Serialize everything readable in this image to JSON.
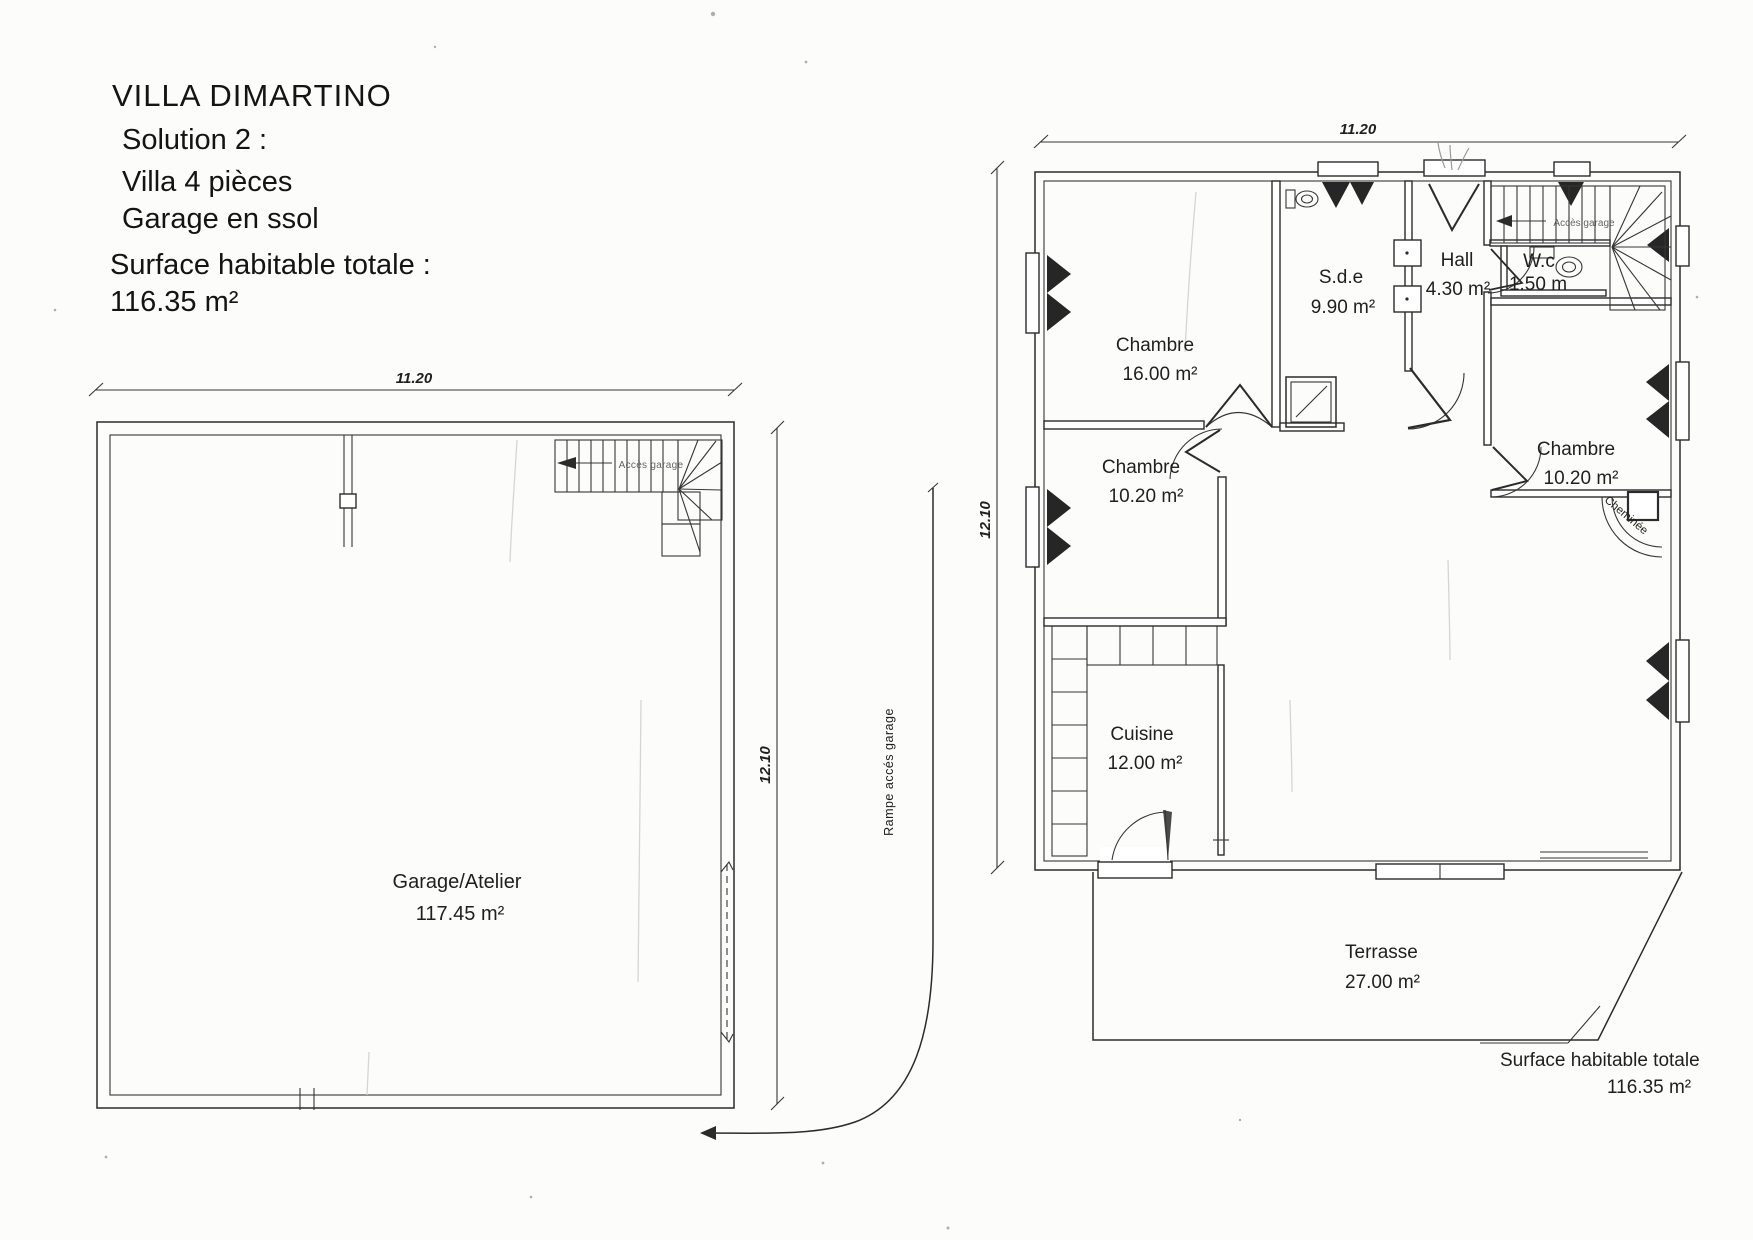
{
  "colors": {
    "ink": "#2b2b2b",
    "paper": "#fcfcfa"
  },
  "header": {
    "title": "VILLA DIMARTINO",
    "solution": "Solution 2 :",
    "villa": "Villa 4 pièces",
    "garage": "Garage en ssol",
    "surface_label": "Surface habitable totale :",
    "surface_value": "116.35 m²"
  },
  "basement": {
    "dim_width": "11.20",
    "dim_height": "12.10",
    "room": {
      "name": "Garage/Atelier",
      "area": "117.45 m²"
    },
    "stairs": "Accès garage",
    "ramp": "Rampe accés garage"
  },
  "floor": {
    "dim_width": "11.20",
    "dim_height": "12.10",
    "bedroom1": {
      "name": "Chambre",
      "area": "16.00 m²"
    },
    "sde": {
      "name": "S.d.e",
      "area": "9.90 m²"
    },
    "hall": {
      "name": "Hall",
      "area": "4.30 m²"
    },
    "wc": {
      "name": "W.c",
      "area": "1.50 m"
    },
    "bedroom2": {
      "name": "Chambre",
      "area": "10.20 m²"
    },
    "bedroom3": {
      "name": "Chambre",
      "area": "10.20 m²"
    },
    "cuisine": {
      "name": "Cuisine",
      "area": "12.00 m²"
    },
    "terrasse": {
      "name": "Terrasse",
      "area": "27.00 m²"
    },
    "stairs": "Accès garage",
    "cheminee": "Cheminée",
    "total": {
      "label": "Surface habitable totale",
      "value": "116.35 m²"
    }
  }
}
